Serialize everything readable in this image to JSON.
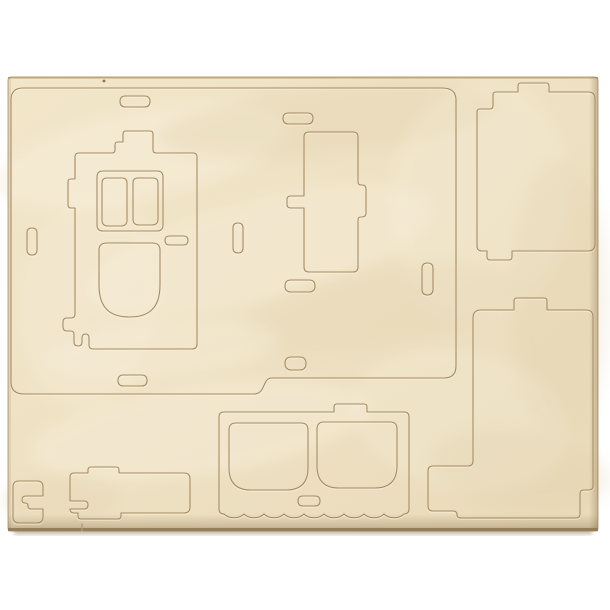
{
  "meta": {
    "subject": "Light birch plywood sheet with laser-cut press-out pieces for a 3D wooden house puzzle kit",
    "visible_pieces": [
      "large base wall panel outline",
      "door piece with two square windows, window frame and arched door window",
      "narrow side post piece with left tab and right notch",
      "top right roof panel with top tab and corner notches",
      "lower right roof panel with top tab and stepped foot",
      "window wall piece with two large rounded windows and scalloped bottom edge",
      "small G-shaped connector piece",
      "bar-shaped chimney piece with top and bottom tabs",
      "ten small oval connector slots"
    ]
  },
  "colors": {
    "background": "#ffffff",
    "wood_base": "#eee1c3",
    "wood_light": "#f8efdc",
    "wood_shade": "#e0cfa8",
    "edge_top_line": "#c6b28a",
    "edge_dark": "#8d7751",
    "cut_line": "#9c7f53",
    "cut_highlight": "#fdf6e4",
    "speck": "#7a5a38",
    "under_shadow": "#b9b2a4"
  },
  "sheet": {
    "x": 8,
    "y": 77,
    "width": 590,
    "height": 454,
    "corner_radius": 3
  },
  "pieces": [
    {
      "name": "base-wall-panel-cut",
      "path": "M 23,88 L 442,88 Q 456,88 456,100 L 456,366 Q 456,378 444,378 L 272,378 C 262,378 266,394 254,394 L 24,394 Q 11,394 11,382 L 11,100 Q 11,88 23,88 Z"
    },
    {
      "name": "door-piece-cut",
      "path": "M 75,176 L 75,157 Q 75,153 79,153 L 112,153 Q 115,153 115,150 L 115,145 Q 115,142 118,142 L 123,142 L 123,134 Q 123,131 126,131 L 150,131 Q 153,131 153,134 L 153,150 Q 153,153 156,153 L 193,153 Q 197,153 197,157 L 197,344 Q 197,349 192,349 L 93,349 Q 89,349 89,345 L 89,338 Q 89,334 85.5,334 Q 82,334 82,338 L 82,342 Q 82,346 78,346 Q 74,346 74,342 L 74,334 Q 74,331 70,331 L 67,331 Q 63,331 63,327 L 63,322 Q 63,318 67,318 L 71,318 Q 75,318 75,314 L 75,208 L 71,208 Q 68,208 68,205 L 68,182 Q 68,179 71,179 L 75,179 Z"
    },
    {
      "name": "door-window-frame-cut",
      "path": "M 103,171 L 157,171 Q 163,171 163,177 L 163,225 Q 163,231 157,231 L 103,231 Q 97,231 97,225 L 97,177 Q 97,171 103,171 Z"
    },
    {
      "name": "door-window-left-cut",
      "path": "M 107,178 L 122,178 Q 127,178 127,183 L 127,220 Q 127,226 121,226 L 108,226 Q 102,226 102,220 L 102,183 Q 102,178 107,178 Z"
    },
    {
      "name": "door-window-right-cut",
      "path": "M 138,178 L 153,178 Q 158,178 158,183 L 158,219 Q 158,225 152,225 L 139,225 Q 133,225 133,219 L 133,183 Q 133,178 138,178 Z"
    },
    {
      "name": "door-arch-window-cut",
      "path": "M 107,243 L 152,243 Q 160,243 160,250 L 160,285 C 160,310 147,317 129.5,317 C 112,317 99,310 99,285 L 99,250 Q 99,243 107,243 Z"
    },
    {
      "name": "side-post-piece-cut",
      "path": "M 309,132 Q 304,132 304,137 L 304,196 L 291,196 Q 287,196 287,199.5 L 287,204.5 Q 287,208 291,208 L 304,208 L 304,267 Q 304,272 309,272 L 353,272 Q 358,272 358,267 L 358,220 Q 358,217 361,217 L 362,217 Q 366,217 366,213 L 366,189 Q 366,185 362,185 L 361,185 Q 358,185 358,182 L 358,137 Q 358,132 353,132 Z"
    },
    {
      "name": "top-right-roof-panel-cut",
      "path": "M 496,92 L 518,92 L 518,86 Q 518,83 521,83 L 546,83 Q 549,83 549,86 L 549,92 L 588,92 Q 595,92 595,99 L 595,244 Q 595,251 588,251 L 512,251 L 512,257 Q 512,260 509,260 L 490,260 Q 487,260 487,257 L 487,251 L 482,251 Q 477,251 477,246 L 477,112 Q 477,109 480,109 L 490,109 Q 493,109 493,106 L 493,95 Q 493,92 496,92 Z"
    },
    {
      "name": "lower-right-roof-panel-cut",
      "path": "M 481,310 L 514,310 L 514,301 Q 514,298 517,298 L 544,298 Q 547,298 547,301 L 547,310 L 586,310 Q 593,310 593,317 L 593,486 Q 593,490 589,490 L 584,490 Q 580,490 580,494 L 580,514 Q 580,518 576,518 L 461,518 Q 457,518 457,515 Q 457,511 453,511 L 433,511 Q 428,511 428,506 L 428,471 Q 428,466 433,466 L 468,466 Q 473,466 473,461 L 473,318 Q 473,310 481,310 Z"
    },
    {
      "name": "window-wall-piece-cut",
      "path": "M 224,412 Q 219,412 219,417 L 219,509 Q 219,514 224,514 c 5,5 15,5 20,0 c 5,5 15,5 20,0 c 5,5 15,5 20,0 c 5,5 15,5 20,0 c 5,5 15,5 20,0 c 5,5 15,5 20,0 c 5,5 15,5 20,0 c 5,5 15,5 20,0 c 5,5 15,5 20,0 Q 409,514 409,509 L 409,417 Q 409,412 404,412 L 367,412 L 367,407 Q 367,404 364,404 L 337,404 Q 334,404 334,407 L 334,412 Z"
    },
    {
      "name": "big-window-left-cut",
      "path": "M 236,423 L 301,423 Q 308,423 308,430 L 308,468 Q 308,490 286,490 L 251,490 Q 229,490 229,468 L 229,430 Q 229,423 236,423 Z"
    },
    {
      "name": "big-window-right-cut",
      "path": "M 324,422 L 390,422 Q 397,422 397,429 L 397,466 Q 397,488 375,488 L 339,488 Q 317,488 317,466 L 317,429 Q 317,422 324,422 Z"
    },
    {
      "name": "g-connector-piece-cut",
      "path": "M 19,481 L 37,481 Q 43,481 43,487 L 43,496 L 26,496 Q 22,496 22,500 Q 22,503 25,503 Q 28,503 28,506 Q 28,509 31,509 L 43,509 L 43,517 Q 43,523 37,523 L 19,523 Q 13,523 13,517 L 13,487 Q 13,481 19,481 Z"
    },
    {
      "name": "chimney-bar-piece-cut",
      "path": "M 74,473 L 88,473 L 88,470 Q 88,467 91,467 L 116,467 Q 119,467 119,470 L 119,473 L 184,473 Q 190,473 190,479 L 190,507 Q 190,513 184,513 L 121,513 L 121,516 Q 121,519 118,519 L 81,519 Q 78,519 78,516 L 78,513 L 74,513 Q 70,513 70,509 L 84,509 Q 88,509 88,505 Q 88,501 84,501 L 70,501 L 70,477 Q 70,473 74,473 Z"
    }
  ],
  "slots": [
    {
      "name": "slot-top-left",
      "x": 120,
      "y": 96,
      "w": 30,
      "h": 11
    },
    {
      "name": "slot-top-middle",
      "x": 283,
      "y": 113,
      "w": 30,
      "h": 11
    },
    {
      "name": "slot-left-vertical",
      "x": 27,
      "y": 228,
      "w": 10,
      "h": 27
    },
    {
      "name": "slot-door-knob",
      "x": 165,
      "y": 236,
      "w": 23,
      "h": 9
    },
    {
      "name": "slot-mid-vertical",
      "x": 233,
      "y": 223,
      "w": 10,
      "h": 30
    },
    {
      "name": "slot-mid-lower",
      "x": 285,
      "y": 280,
      "w": 30,
      "h": 12
    },
    {
      "name": "slot-right-vertical",
      "x": 422,
      "y": 263,
      "w": 11,
      "h": 32
    },
    {
      "name": "slot-left-lower",
      "x": 118,
      "y": 375,
      "w": 29,
      "h": 11
    },
    {
      "name": "slot-mid-bottom",
      "x": 285,
      "y": 357,
      "w": 21,
      "h": 13
    },
    {
      "name": "slot-under-windows",
      "x": 298,
      "y": 496,
      "w": 22,
      "h": 10
    }
  ],
  "marks": [
    {
      "name": "tiny-edge-cut",
      "path": "M 82,524 L 82,531"
    }
  ],
  "specks": [
    {
      "name": "wood-speck",
      "cx": 104,
      "cy": 81,
      "r": 1.4
    }
  ],
  "grain": [
    {
      "cx": 140,
      "cy": 155,
      "rx": 150,
      "ry": 45,
      "rot": -12,
      "tone": "light",
      "opacity": 0.5
    },
    {
      "cx": 330,
      "cy": 120,
      "rx": 170,
      "ry": 35,
      "rot": -6,
      "tone": "dark",
      "opacity": 0.3
    },
    {
      "cx": 90,
      "cy": 300,
      "rx": 70,
      "ry": 110,
      "rot": 8,
      "tone": "light",
      "opacity": 0.3
    },
    {
      "cx": 260,
      "cy": 250,
      "rx": 180,
      "ry": 50,
      "rot": -14,
      "tone": "light",
      "opacity": 0.4
    },
    {
      "cx": 480,
      "cy": 200,
      "rx": 90,
      "ry": 120,
      "rot": 5,
      "tone": "light",
      "opacity": 0.28
    },
    {
      "cx": 200,
      "cy": 430,
      "rx": 170,
      "ry": 45,
      "rot": -8,
      "tone": "light",
      "opacity": 0.45
    },
    {
      "cx": 460,
      "cy": 420,
      "rx": 110,
      "ry": 70,
      "rot": 12,
      "tone": "light",
      "opacity": 0.3
    },
    {
      "cx": 560,
      "cy": 300,
      "rx": 50,
      "ry": 140,
      "rot": 0,
      "tone": "dark",
      "opacity": 0.22
    },
    {
      "cx": 380,
      "cy": 310,
      "rx": 140,
      "ry": 40,
      "rot": -10,
      "tone": "dark",
      "opacity": 0.22
    },
    {
      "cx": 520,
      "cy": 470,
      "rx": 90,
      "ry": 40,
      "rot": 8,
      "tone": "dark",
      "opacity": 0.26
    },
    {
      "cx": 60,
      "cy": 500,
      "rx": 60,
      "ry": 25,
      "rot": 0,
      "tone": "dark",
      "opacity": 0.25
    },
    {
      "cx": 160,
      "cy": 350,
      "rx": 120,
      "ry": 30,
      "rot": -6,
      "tone": "light",
      "opacity": 0.35
    }
  ]
}
